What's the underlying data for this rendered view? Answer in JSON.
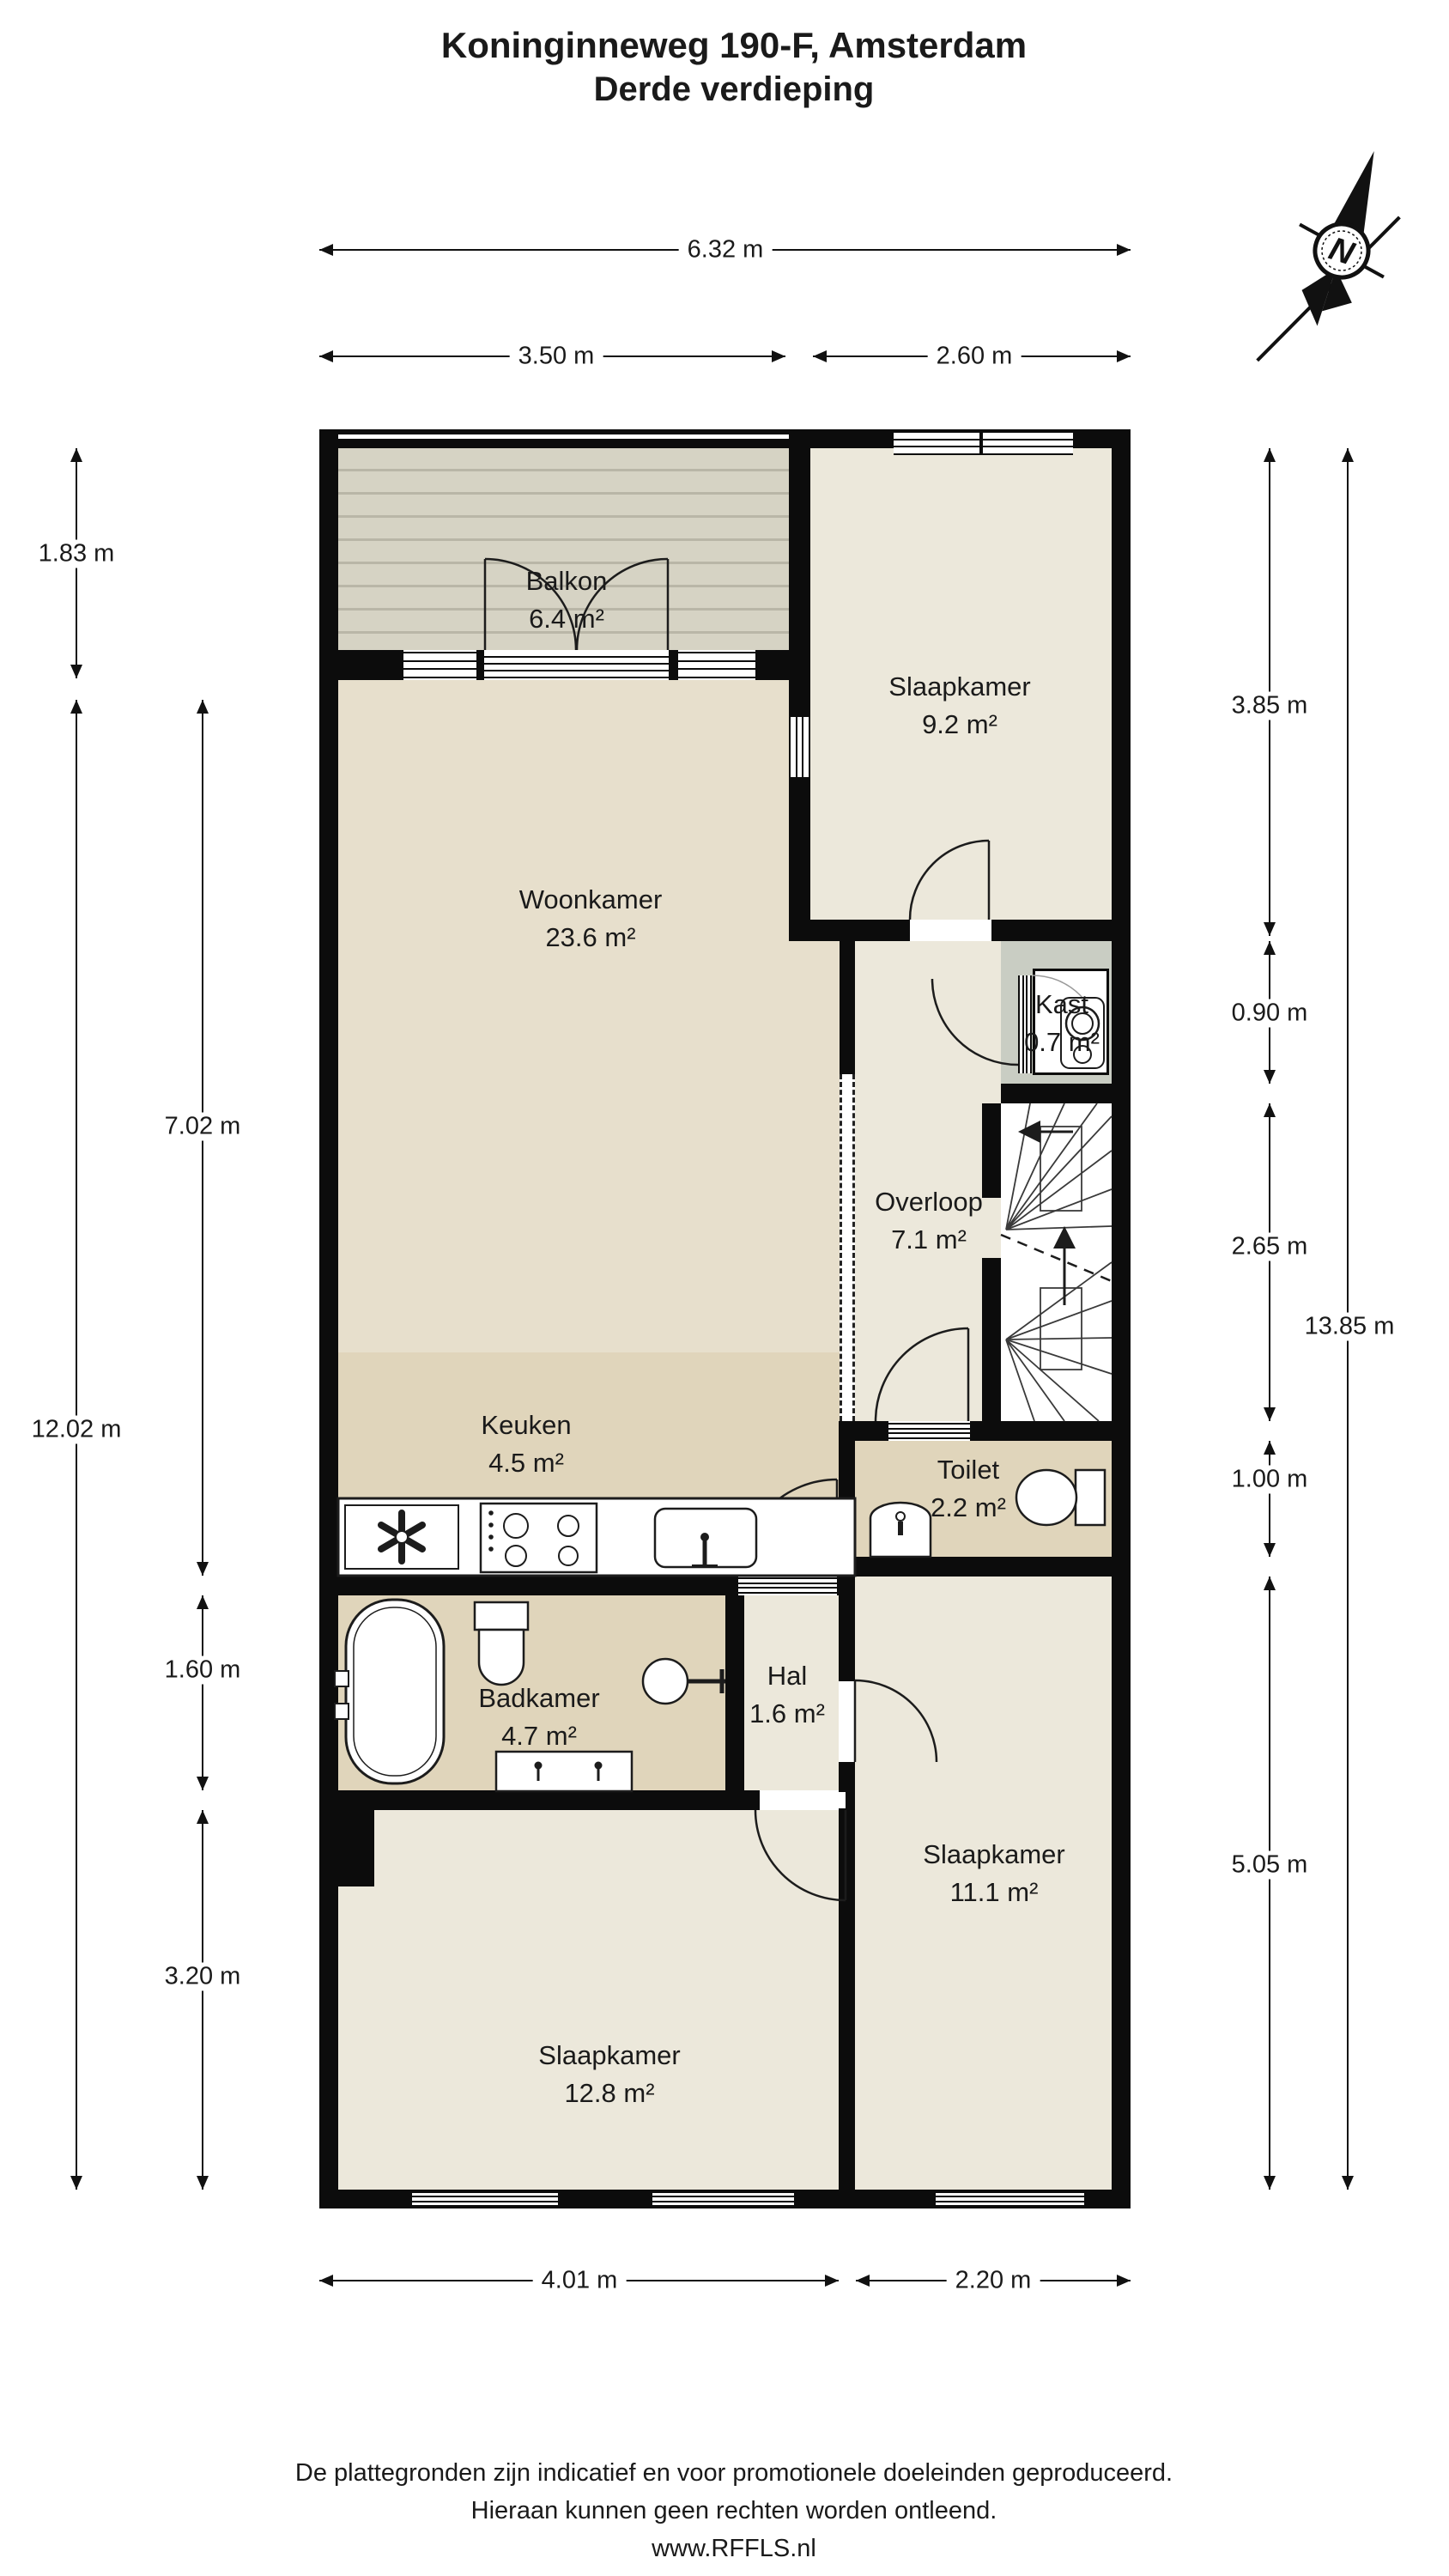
{
  "title": {
    "line1": "Koninginneweg 190-F, Amsterdam",
    "line2": "Derde verdieping"
  },
  "compass": {
    "north_label": "N"
  },
  "rooms": {
    "balkon": {
      "name": "Balkon",
      "area": "6.4 m²"
    },
    "slaapkamer_top": {
      "name": "Slaapkamer",
      "area": "9.2 m²"
    },
    "woonkamer": {
      "name": "Woonkamer",
      "area": "23.6 m²"
    },
    "overloop": {
      "name": "Overloop",
      "area": "7.1 m²"
    },
    "kast": {
      "name": "Kast",
      "area": "0.7 m²"
    },
    "keuken": {
      "name": "Keuken",
      "area": "4.5 m²"
    },
    "toilet": {
      "name": "Toilet",
      "area": "2.2 m²"
    },
    "badkamer": {
      "name": "Badkamer",
      "area": "4.7 m²"
    },
    "hal": {
      "name": "Hal",
      "area": "1.6 m²"
    },
    "slaapkamer_left": {
      "name": "Slaapkamer",
      "area": "12.8 m²"
    },
    "slaapkamer_right": {
      "name": "Slaapkamer",
      "area": "11.1 m²"
    }
  },
  "dimensions": {
    "top_total": "6.32 m",
    "top_left": "3.50 m",
    "top_right": "2.60 m",
    "bottom_left": "4.01 m",
    "bottom_right": "2.20 m",
    "left_balcony": "1.83 m",
    "left_total": "12.02 m",
    "left_upper": "7.02 m",
    "left_bath": "1.60 m",
    "left_bedroom": "3.20 m",
    "right_bedroom_top": "3.85 m",
    "right_closet": "0.90 m",
    "right_stairs": "2.65 m",
    "right_toilet": "1.00 m",
    "right_bedroom_bottom": "5.05 m",
    "right_total": "13.85 m"
  },
  "footer": {
    "line1": "De plattegronden zijn indicatief en voor promotionele doeleinden geproduceerd.",
    "line2": "Hieraan kunnen geen rechten worden ontleend.",
    "line3": "www.RFFLS.nl"
  },
  "colors": {
    "wall": "#0c0c0c",
    "room_light": "#ece8db",
    "living": "#e7dfcc",
    "service": "#e0d5bb",
    "kast_surround": "#c9cdc3",
    "balkon_base": "#d6d3c4",
    "balkon_stripe": "#b9b6a7",
    "ink": "#1a1a1a"
  }
}
